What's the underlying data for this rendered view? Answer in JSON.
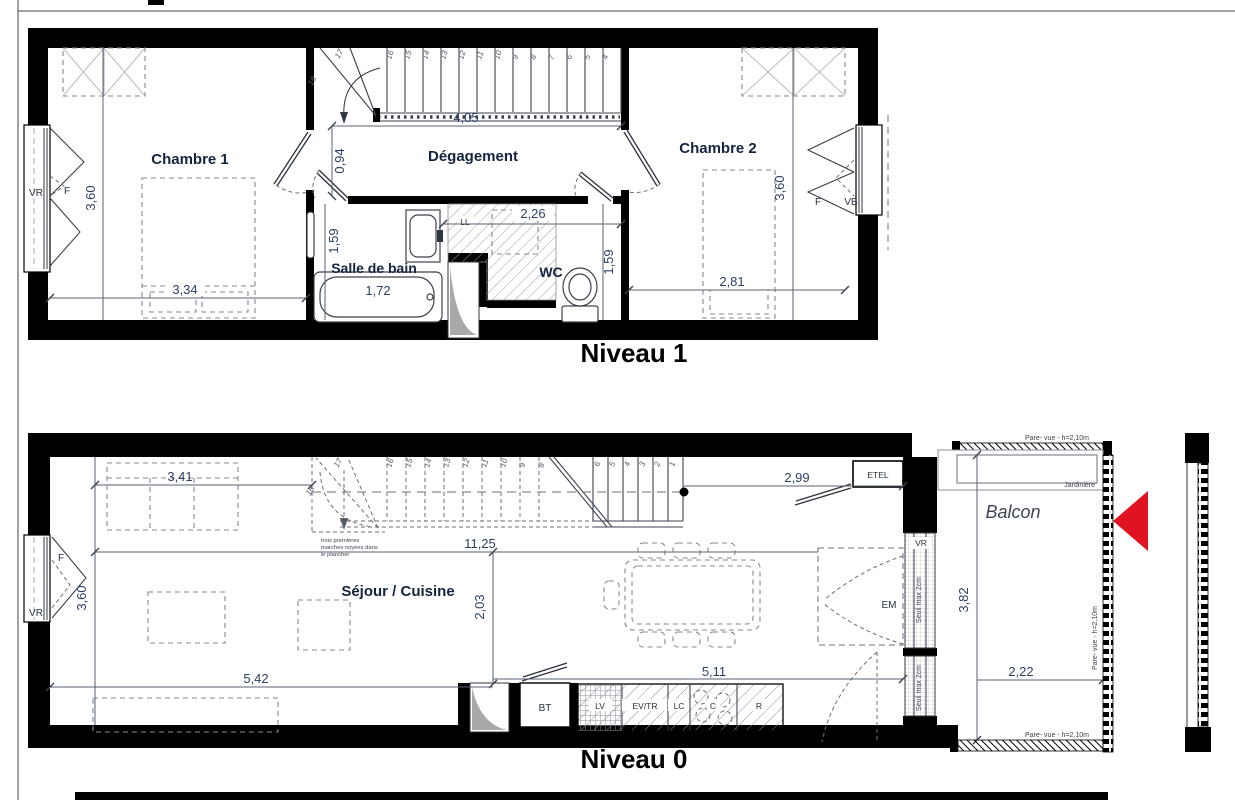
{
  "colors": {
    "wall": "#000000",
    "arrow_red": "#e01322",
    "dim_text": "#2c3f63",
    "room_label": "#15233f"
  },
  "level1": {
    "title": "Niveau 1",
    "rooms": {
      "chambre1": "Chambre 1",
      "degagement": "Dégagement",
      "chambre2": "Chambre 2",
      "salle_de_bain": "Salle de bain",
      "wc": "WC"
    },
    "labels": {
      "vr_left": "VR",
      "f_left": "F",
      "f_right": "F",
      "vb_right": "VB",
      "ll": "LL"
    },
    "dims": {
      "chambre1_width": "3,34",
      "chambre1_height": "3,60",
      "stair_width": "4,05",
      "degagement_depth": "0,94",
      "bath_length": "1,72",
      "bath_depth": "1,59",
      "wc_width": "2,26",
      "wc_depth": "1,59",
      "chambre2_width": "2,81",
      "chambre2_height": "3,60"
    },
    "stairs": {
      "winders": [
        "17",
        "18"
      ],
      "run": [
        "16",
        "15",
        "14",
        "13",
        "12",
        "11",
        "10",
        "9",
        "8",
        "7",
        "6",
        "5",
        "4"
      ]
    }
  },
  "level0": {
    "title": "Niveau 0",
    "rooms": {
      "sejour_cuisine": "Séjour / Cuisine",
      "balcon": "Balcon"
    },
    "labels": {
      "etel": "ETEL",
      "em": "EM",
      "bt": "BT",
      "lv": "LV",
      "ev_tr": "EV/TR",
      "lc": "LC",
      "c": "C",
      "r": "R",
      "vr_left": "VR",
      "f_left": "F",
      "vr_right": "VR",
      "jardiniere": "Jardinière",
      "seuil_top": "Seuil max 2cm",
      "seuil_bottom": "Seuil max 2cm",
      "pare_vue_top": "Pare- vue - h=2,10m",
      "pare_vue_right": "Pare- vue - h=2,10m",
      "pare_vue_bottom": "Pare- vue - h=2,10m",
      "note_line1": "trois premières",
      "note_line2": "marches noyées dans",
      "note_line3": "le plancher"
    },
    "dims": {
      "left_to_stairs": "3,41",
      "stairs_to_wall": "2,99",
      "room_length": "11,25",
      "kitchen_depth": "2,03",
      "room_height_left": "3,60",
      "sejour_width": "5,42",
      "kitchen_width": "5,11",
      "balcon_depth": "3,82",
      "balcon_width": "2,22"
    },
    "stairs": {
      "winders": [
        "17",
        "18"
      ],
      "run_a": [
        "16",
        "15",
        "14",
        "13",
        "12",
        "11",
        "10",
        "9",
        "8"
      ],
      "run_b": [
        "6",
        "5",
        "4",
        "3",
        "2",
        "1"
      ]
    }
  }
}
